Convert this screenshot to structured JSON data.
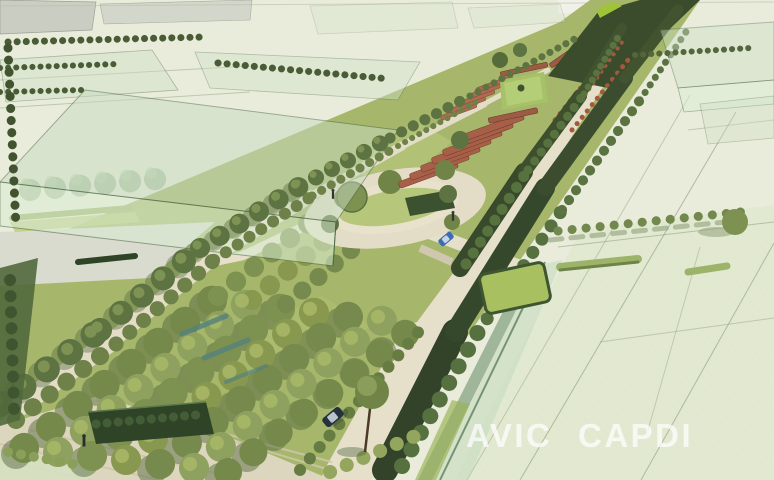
{
  "watermark": {
    "word1": "AVIC",
    "word2": "CAPDI",
    "color": "#ffffff"
  },
  "palette": {
    "background": "#e9ecda",
    "parcel_green": "#e2e9d1",
    "massing_glass": "#cde0c6",
    "massing_outline": "#4f6a4b",
    "tree_dark": "#3c4e2d",
    "tree_mid": "#7d9150",
    "tree_light": "#a3b46d",
    "lawn": "#a6b76c",
    "hedge_dark": "#2f4427",
    "road_beige": "#e6e0cb",
    "plaza_paving": "#ddd6bf",
    "pavilion_roof": "#a85f48",
    "water_teal": "#55827a",
    "car_dark": "#26303e",
    "car_blue": "#3c6db0"
  },
  "scene": {
    "type": "aerial landscape-architecture rendering",
    "features": [
      "linear greenway park",
      "double tree allées",
      "terracotta pavilion rows",
      "central oval lawn",
      "bosque tree grove",
      "pedestrian plaza",
      "translucent building massing blocks",
      "parcel grid"
    ],
    "vehicle_count": 2,
    "pedestrian_count": 3
  }
}
